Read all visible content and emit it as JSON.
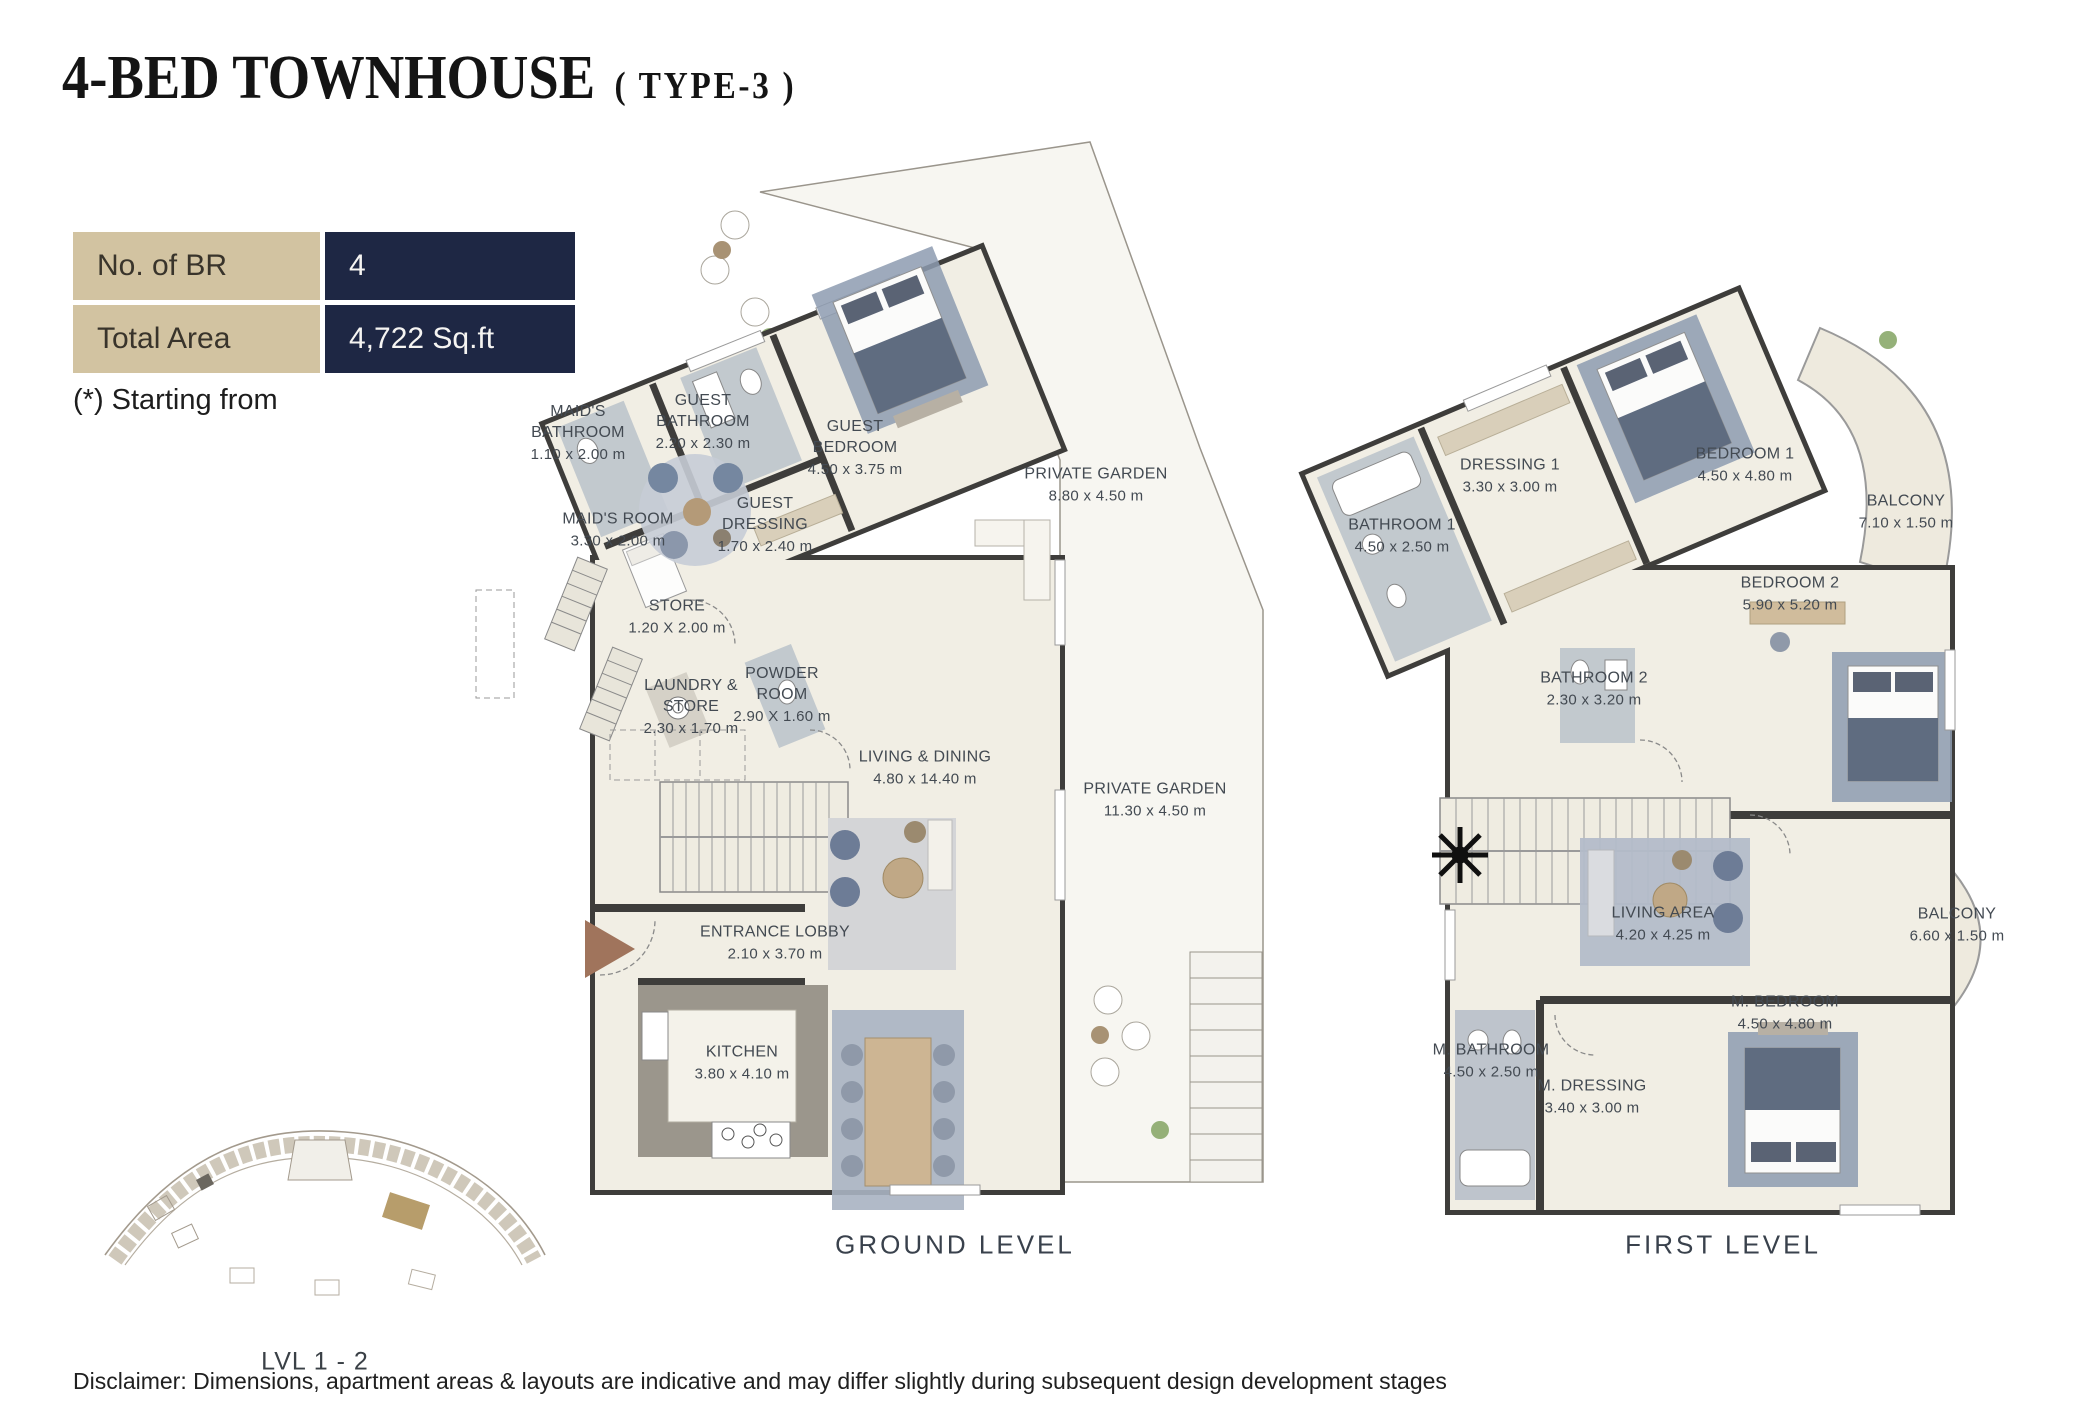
{
  "header": {
    "title": "4-BED TOWNHOUSE",
    "subtitle": "( TYPE-3 )"
  },
  "info_table": {
    "rows": [
      {
        "label": "No. of BR",
        "value": "4"
      },
      {
        "label": "Total Area",
        "value": "4,722 Sq.ft"
      }
    ],
    "footnote": "(*) Starting from"
  },
  "ground_level": {
    "caption": "GROUND LEVEL",
    "rooms": [
      {
        "name": "MAID'S BATHROOM",
        "dims": "1.10 x 2.00 m"
      },
      {
        "name": "GUEST BATHROOM",
        "dims": "2.20 x 2.30 m"
      },
      {
        "name": "GUEST BEDROOM",
        "dims": "4.50 x 3.75 m"
      },
      {
        "name": "MAID'S ROOM",
        "dims": "3.30 x 2.00 m"
      },
      {
        "name": "GUEST DRESSING",
        "dims": "1.70 x 2.40 m"
      },
      {
        "name": "STORE",
        "dims": "1.20 X 2.00 m"
      },
      {
        "name": "LAUNDRY & STORE",
        "dims": "2.30 x 1.70 m"
      },
      {
        "name": "POWDER ROOM",
        "dims": "2.90 X 1.60 m"
      },
      {
        "name": "LIVING & DINING",
        "dims": "4.80 x 14.40 m"
      },
      {
        "name": "ENTRANCE LOBBY",
        "dims": "2.10 x 3.70 m"
      },
      {
        "name": "KITCHEN",
        "dims": "3.80 x 4.10 m"
      },
      {
        "name": "PRIVATE GARDEN",
        "dims": "8.80 x 4.50 m"
      },
      {
        "name": "PRIVATE GARDEN",
        "dims": "11.30 x 4.50 m"
      }
    ]
  },
  "first_level": {
    "caption": "FIRST LEVEL",
    "rooms": [
      {
        "name": "DRESSING 1",
        "dims": "3.30 x 3.00 m"
      },
      {
        "name": "BEDROOM 1",
        "dims": "4.50 x 4.80 m"
      },
      {
        "name": "BALCONY",
        "dims": "7.10 x 1.50 m"
      },
      {
        "name": "BATHROOM 1",
        "dims": "4.50 x 2.50 m"
      },
      {
        "name": "BEDROOM 2",
        "dims": "5.90 x 5.20 m"
      },
      {
        "name": "BATHROOM 2",
        "dims": "2.30 x 3.20 m"
      },
      {
        "name": "LIVING AREA",
        "dims": "4.20 x 4.25 m"
      },
      {
        "name": "BALCONY",
        "dims": "6.60 x 1.50 m"
      },
      {
        "name": "M. BEDROOM",
        "dims": "4.50 x 4.80 m"
      },
      {
        "name": "M. BATHROOM",
        "dims": "4.50 x 2.50 m"
      },
      {
        "name": "M. DRESSING",
        "dims": "3.40 x 3.00 m"
      }
    ]
  },
  "site_plan": {
    "caption": "LVL 1 - 2"
  },
  "disclaimer": "Disclaimer: Dimensions, apartment areas & layouts are indicative and may differ slightly during subsequent design development stages",
  "colors": {
    "tan": "#d2c3a1",
    "navy": "#1e2744",
    "wall": "#3e3d3b",
    "floor_cream": "#f1eee4",
    "garden": "#f7f6f1",
    "rug_blue": "#8d9bb0",
    "entrance_arrow": "#a0745c"
  }
}
